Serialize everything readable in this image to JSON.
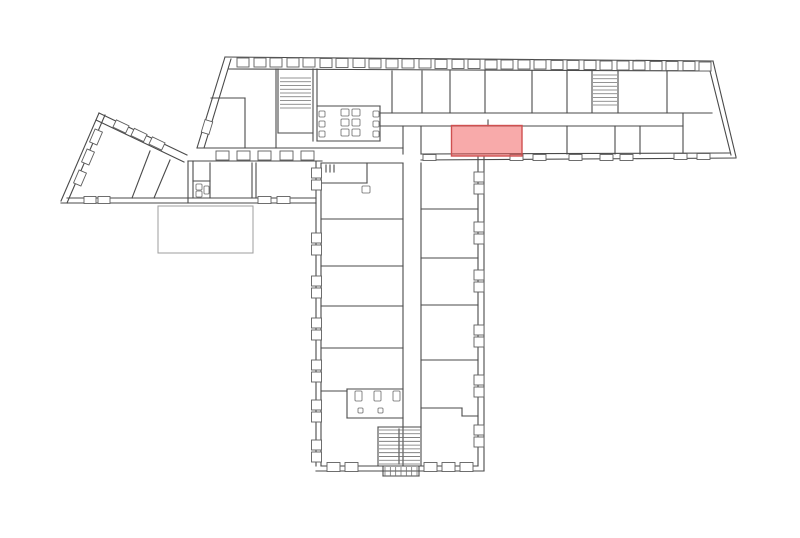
{
  "meta": {
    "canvas": {
      "w": 800,
      "h": 538
    },
    "background": "#ffffff",
    "wall_color": "#4a4a4a",
    "highlight_fill": "#f25555",
    "highlight_stroke": "#cf5050"
  },
  "highlight": {
    "x": 451.5,
    "y": 125.5,
    "w": 70.5,
    "h": 30.5
  },
  "plan": {
    "lines": [
      [
        225,
        57,
        713,
        61
      ],
      [
        229,
        69,
        711,
        71
      ],
      [
        713,
        61,
        736,
        157
      ],
      [
        708,
        63,
        731,
        155
      ],
      [
        421,
        160,
        736,
        158
      ],
      [
        421,
        154,
        730,
        153
      ],
      [
        225,
        57,
        197,
        148
      ],
      [
        231,
        59,
        204,
        148
      ],
      [
        197,
        148,
        403,
        148
      ],
      [
        188,
        161,
        322,
        161
      ],
      [
        188,
        161,
        188,
        203
      ],
      [
        193,
        161,
        193,
        198
      ],
      [
        61,
        203,
        316,
        203
      ],
      [
        67,
        198,
        316,
        198
      ],
      [
        99,
        113,
        187,
        155
      ],
      [
        96,
        120,
        184,
        162
      ],
      [
        99,
        113,
        61,
        201
      ],
      [
        105,
        115,
        67,
        203
      ],
      [
        316,
        161,
        316,
        466
      ],
      [
        321,
        163,
        321,
        466
      ],
      [
        484,
        157,
        484,
        471
      ],
      [
        478,
        157,
        478,
        466
      ],
      [
        316,
        471,
        484,
        471
      ],
      [
        321,
        466,
        478,
        466
      ],
      [
        380,
        113,
        712,
        113
      ],
      [
        380,
        126,
        683,
        126
      ],
      [
        392,
        71,
        392,
        113
      ],
      [
        422,
        71,
        422,
        113
      ],
      [
        450,
        71,
        450,
        113
      ],
      [
        485,
        71,
        485,
        113
      ],
      [
        532,
        71,
        532,
        113
      ],
      [
        567,
        71,
        567,
        113
      ],
      [
        592,
        71,
        592,
        112
      ],
      [
        618,
        71,
        618,
        113
      ],
      [
        667,
        71,
        667,
        113
      ],
      [
        567,
        126,
        567,
        154
      ],
      [
        615,
        126,
        615,
        154
      ],
      [
        640,
        126,
        640,
        154
      ],
      [
        683,
        113,
        683,
        157
      ],
      [
        421,
        126,
        421,
        154
      ],
      [
        403,
        126,
        403,
        154
      ],
      [
        211,
        98,
        245,
        98
      ],
      [
        245,
        98,
        245,
        148
      ],
      [
        276,
        69,
        276,
        148
      ],
      [
        278,
        69,
        278,
        133
      ],
      [
        313,
        69,
        313,
        141
      ],
      [
        317,
        69,
        317,
        141
      ],
      [
        278,
        133,
        313,
        133
      ],
      [
        317,
        106,
        380,
        106
      ],
      [
        380,
        106,
        380,
        141
      ],
      [
        317,
        141,
        380,
        141
      ],
      [
        403,
        163,
        403,
        466
      ],
      [
        421,
        163,
        421,
        466
      ],
      [
        321,
        219,
        403,
        219
      ],
      [
        321,
        266,
        403,
        266
      ],
      [
        321,
        306,
        403,
        306
      ],
      [
        321,
        348,
        403,
        348
      ],
      [
        321,
        391,
        347,
        391
      ],
      [
        347,
        389,
        403,
        389
      ],
      [
        347,
        389,
        347,
        418
      ],
      [
        347,
        418,
        403,
        418
      ],
      [
        378,
        427,
        421,
        427
      ],
      [
        378,
        427,
        378,
        466
      ],
      [
        399,
        429,
        399,
        464
      ],
      [
        383,
        466,
        383,
        476
      ],
      [
        383,
        476,
        419,
        476
      ],
      [
        419,
        466,
        419,
        476
      ],
      [
        322,
        163,
        403,
        163
      ],
      [
        367,
        163,
        367,
        183
      ],
      [
        322,
        183,
        367,
        183
      ],
      [
        326,
        165,
        326,
        172
      ],
      [
        330,
        165,
        330,
        172
      ],
      [
        334,
        165,
        334,
        172
      ],
      [
        421,
        209,
        478,
        209
      ],
      [
        421,
        258,
        478,
        258
      ],
      [
        421,
        305,
        478,
        305
      ],
      [
        421,
        360,
        478,
        360
      ],
      [
        421,
        408,
        462,
        408
      ],
      [
        462,
        408,
        462,
        416
      ],
      [
        462,
        416,
        478,
        416
      ],
      [
        210,
        163,
        210,
        198
      ],
      [
        193,
        181,
        210,
        181
      ],
      [
        252,
        163,
        252,
        198
      ],
      [
        256,
        163,
        256,
        198
      ],
      [
        150,
        151,
        132,
        198
      ],
      [
        170,
        160,
        154,
        198
      ],
      [
        488,
        120,
        488,
        126
      ]
    ],
    "windows": [
      {
        "w": 12,
        "h": 9,
        "items": [
          [
            237,
            58
          ],
          [
            254,
            58
          ],
          [
            270,
            58
          ],
          [
            287,
            58
          ],
          [
            303,
            58
          ],
          [
            320,
            58.5
          ],
          [
            336,
            58.5
          ],
          [
            353,
            58.5
          ],
          [
            369,
            59
          ],
          [
            386,
            59
          ],
          [
            402,
            59
          ],
          [
            419,
            59
          ],
          [
            435,
            59.5
          ],
          [
            452,
            59.5
          ],
          [
            468,
            59.5
          ],
          [
            485,
            60
          ],
          [
            501,
            60
          ],
          [
            518,
            60
          ],
          [
            534,
            60
          ],
          [
            551,
            60.5
          ],
          [
            567,
            60.5
          ],
          [
            584,
            60.5
          ],
          [
            600,
            61
          ],
          [
            617,
            61
          ],
          [
            633,
            61
          ],
          [
            650,
            61.5
          ],
          [
            666,
            61.5
          ],
          [
            683,
            61.5
          ],
          [
            699,
            62
          ]
        ]
      },
      {
        "w": 13,
        "h": 6,
        "items": [
          [
            423,
            154.5
          ],
          [
            510,
            154.5
          ],
          [
            533,
            154.5
          ],
          [
            569,
            154.5
          ],
          [
            600,
            154.5
          ],
          [
            620,
            154.5
          ],
          [
            674,
            153.5
          ],
          [
            697,
            153.5
          ]
        ]
      },
      {
        "w": 13,
        "h": 9,
        "items": [
          [
            216,
            151
          ],
          [
            237,
            151
          ],
          [
            258,
            151
          ],
          [
            280,
            151
          ],
          [
            301,
            151
          ]
        ]
      },
      {
        "w": 13,
        "h": 7,
        "items": [
          [
            258,
            196.5
          ],
          [
            277,
            196.5
          ]
        ]
      },
      {
        "w": 12,
        "h": 7,
        "items": [
          [
            84,
            196.5
          ],
          [
            98,
            196.5
          ]
        ]
      },
      {
        "w": 10,
        "h": 10,
        "items": [
          [
            311.5,
            168
          ],
          [
            311.5,
            180
          ],
          [
            311.5,
            233
          ],
          [
            311.5,
            245
          ],
          [
            311.5,
            276
          ],
          [
            311.5,
            288
          ],
          [
            311.5,
            318
          ],
          [
            311.5,
            330
          ],
          [
            311.5,
            360
          ],
          [
            311.5,
            372
          ],
          [
            311.5,
            400
          ],
          [
            311.5,
            412
          ],
          [
            311.5,
            440
          ],
          [
            311.5,
            452
          ]
        ]
      },
      {
        "w": 10,
        "h": 10,
        "items": [
          [
            474,
            172
          ],
          [
            474,
            184
          ],
          [
            474,
            222
          ],
          [
            474,
            234
          ],
          [
            474,
            270
          ],
          [
            474,
            282
          ],
          [
            474,
            325
          ],
          [
            474,
            337
          ],
          [
            474,
            375
          ],
          [
            474,
            387
          ],
          [
            474,
            425
          ],
          [
            474,
            437
          ]
        ]
      },
      {
        "w": 13,
        "h": 9,
        "items": [
          [
            327,
            462.5
          ],
          [
            345,
            462.5
          ],
          [
            424,
            462.5
          ],
          [
            442,
            462.5
          ],
          [
            460,
            462.5
          ]
        ]
      }
    ],
    "rot_windows": [
      {
        "cx": 121,
        "cy": 126.5,
        "w": 14,
        "h": 8,
        "a": 25.5
      },
      {
        "cx": 139,
        "cy": 135,
        "w": 14,
        "h": 8,
        "a": 25.5
      },
      {
        "cx": 157,
        "cy": 143.5,
        "w": 14,
        "h": 8,
        "a": 25.5
      },
      {
        "cx": 80,
        "cy": 178,
        "w": 14,
        "h": 8,
        "a": 113.3
      },
      {
        "cx": 88,
        "cy": 157,
        "w": 14,
        "h": 8,
        "a": 113.3
      },
      {
        "cx": 96,
        "cy": 137,
        "w": 14,
        "h": 8,
        "a": 113.3
      },
      {
        "cx": 207,
        "cy": 127,
        "w": 13,
        "h": 8,
        "a": 107
      }
    ],
    "fixtures": [
      [
        341,
        109,
        8,
        7
      ],
      [
        341,
        119,
        8,
        7
      ],
      [
        341,
        129,
        8,
        7
      ],
      [
        352,
        109,
        8,
        7
      ],
      [
        352,
        119,
        8,
        7
      ],
      [
        352,
        129,
        8,
        7
      ],
      [
        319,
        111,
        6,
        6
      ],
      [
        319,
        121,
        6,
        6
      ],
      [
        319,
        131,
        6,
        6
      ],
      [
        373,
        111,
        6,
        6
      ],
      [
        373,
        121,
        6,
        6
      ],
      [
        373,
        131,
        6,
        6
      ],
      [
        196,
        184,
        6,
        6
      ],
      [
        196,
        191,
        6,
        6
      ],
      [
        204,
        186,
        5,
        8
      ],
      [
        355,
        391,
        7,
        10
      ],
      [
        374,
        391,
        7,
        10
      ],
      [
        393,
        391,
        7,
        10
      ],
      [
        358,
        408,
        5,
        5
      ],
      [
        378,
        408,
        5,
        5
      ],
      [
        362,
        186,
        8,
        7
      ]
    ],
    "stairs": [
      {
        "x": 280,
        "y": 78,
        "w": 31,
        "h": 30,
        "steps": 9,
        "dir": "h"
      },
      {
        "x": 593,
        "y": 75,
        "w": 24,
        "h": 30,
        "steps": 9,
        "dir": "h"
      },
      {
        "x": 379,
        "y": 430,
        "w": 41,
        "h": 34,
        "steps": 10,
        "dir": "h"
      },
      {
        "x": 385,
        "y": 467,
        "w": 32,
        "h": 9,
        "steps": 7,
        "dir": "v"
      }
    ],
    "terrace": {
      "x": 158,
      "y": 206,
      "w": 95,
      "h": 47
    }
  }
}
